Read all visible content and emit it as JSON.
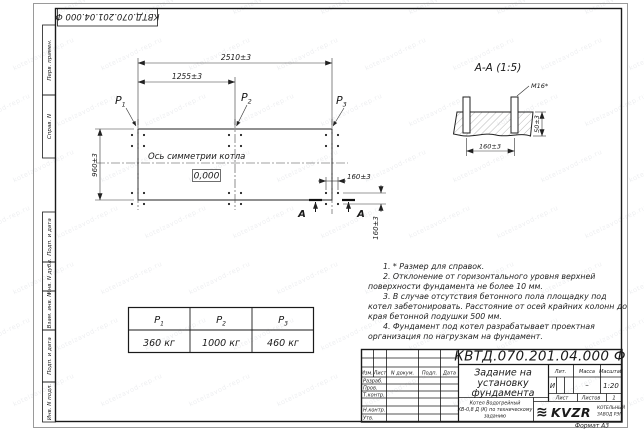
{
  "watermark": {
    "text": "kotelzavod-rep.ru"
  },
  "frame": {
    "format_label": "Формат А3",
    "columns": [
      {
        "label": "Перв. примен."
      },
      {
        "label": "Справ. N"
      },
      {
        "label": "Подп. и дата"
      },
      {
        "label": "Инв. N дубл."
      },
      {
        "label": "Взам. инв. N"
      },
      {
        "label": "Подп. и дата"
      },
      {
        "label": "Инв. N подл."
      }
    ]
  },
  "plan": {
    "dim_overall": "2510±3",
    "dim_half": "1255±3",
    "dim_height": "960±3",
    "dim_bolt_x": "160±3",
    "dim_bolt_y": "160±3",
    "axis_label": "Ось симметрии котла",
    "level": "0,000",
    "loads": [
      {
        "name": "P",
        "sub": "1"
      },
      {
        "name": "P",
        "sub": "2"
      },
      {
        "name": "P",
        "sub": "3"
      }
    ],
    "section_letter": "А"
  },
  "section": {
    "title": "А-А (1:5)",
    "thread": "М16*",
    "dim_depth": "50±3",
    "dim_spacing": "160±3"
  },
  "notes": {
    "items": [
      "1. * Размер для справок.",
      "2. Отклонение от горизонтального уровня верхней поверхности фундамента не более 10 мм.",
      "3. В случае отсутствия бетонного пола площадку под котел забетонировать. Расстояние от осей крайних колонн до края бетонной подушки 500 мм.",
      "4. Фундамент под котел разрабатывает проектная организация по нагрузкам на фундамент."
    ]
  },
  "load_table": {
    "headers": [
      {
        "name": "P",
        "sub": "1"
      },
      {
        "name": "P",
        "sub": "2"
      },
      {
        "name": "P",
        "sub": "3"
      }
    ],
    "values": [
      "360 кг",
      "1000 кг",
      "460 кг"
    ]
  },
  "title_block": {
    "designation": "КВТД.070.201.04.000  Ф",
    "doc_title_line1": "Задание на",
    "doc_title_line2": "установку",
    "doc_title_line3": "фундамента",
    "rev_headers": [
      "Изм.",
      "Лист",
      "N докум.",
      "Подп.",
      "Дата"
    ],
    "roles": [
      "Разраб.",
      "Пров.",
      "Т.контр.",
      "Н.контр.",
      "Утв."
    ],
    "lit_label": "Лит.",
    "mass_label": "Масса",
    "scale_label": "Масштаб",
    "lit_value": "И",
    "mass_value": "–",
    "scale_value": "1:20",
    "sheet_label": "Лист",
    "sheets_label": "Листов",
    "sheets_value": "1",
    "product_line1": "Котел Водогрейный",
    "product_line2": "КВ-0,8 Д (К) по техническому",
    "product_line3": "заданию",
    "logo_icon_glyph": "≋",
    "logo_text": "KVZR",
    "logo_sub1": "КОТЕЛЬНЫЙ",
    "logo_sub2": "ЗАВОД РЭП",
    "logo_sub_color": "#a0523d"
  }
}
